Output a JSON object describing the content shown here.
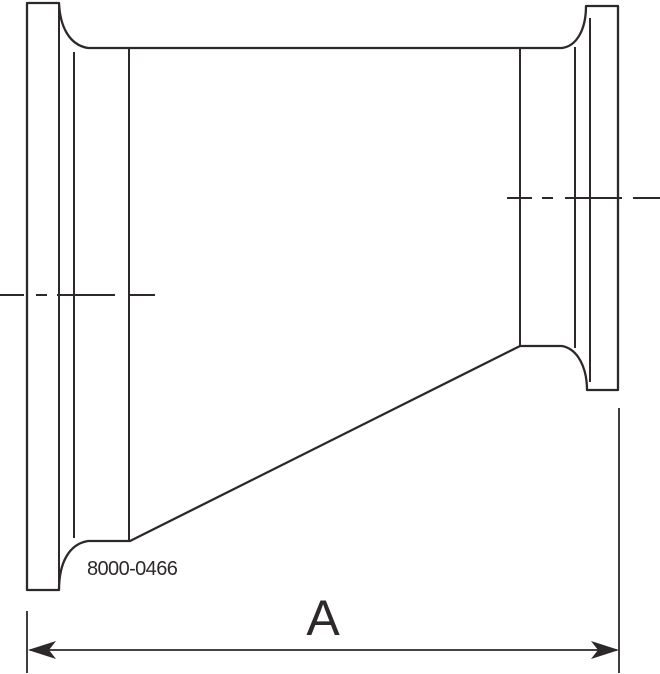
{
  "drawing": {
    "type": "eccentric-reducer-clamp-fitting-elevation",
    "part_number": "8000-0466",
    "dimension_label": "A"
  },
  "colors": {
    "line": "#2d282a",
    "background": "#ffffff"
  }
}
